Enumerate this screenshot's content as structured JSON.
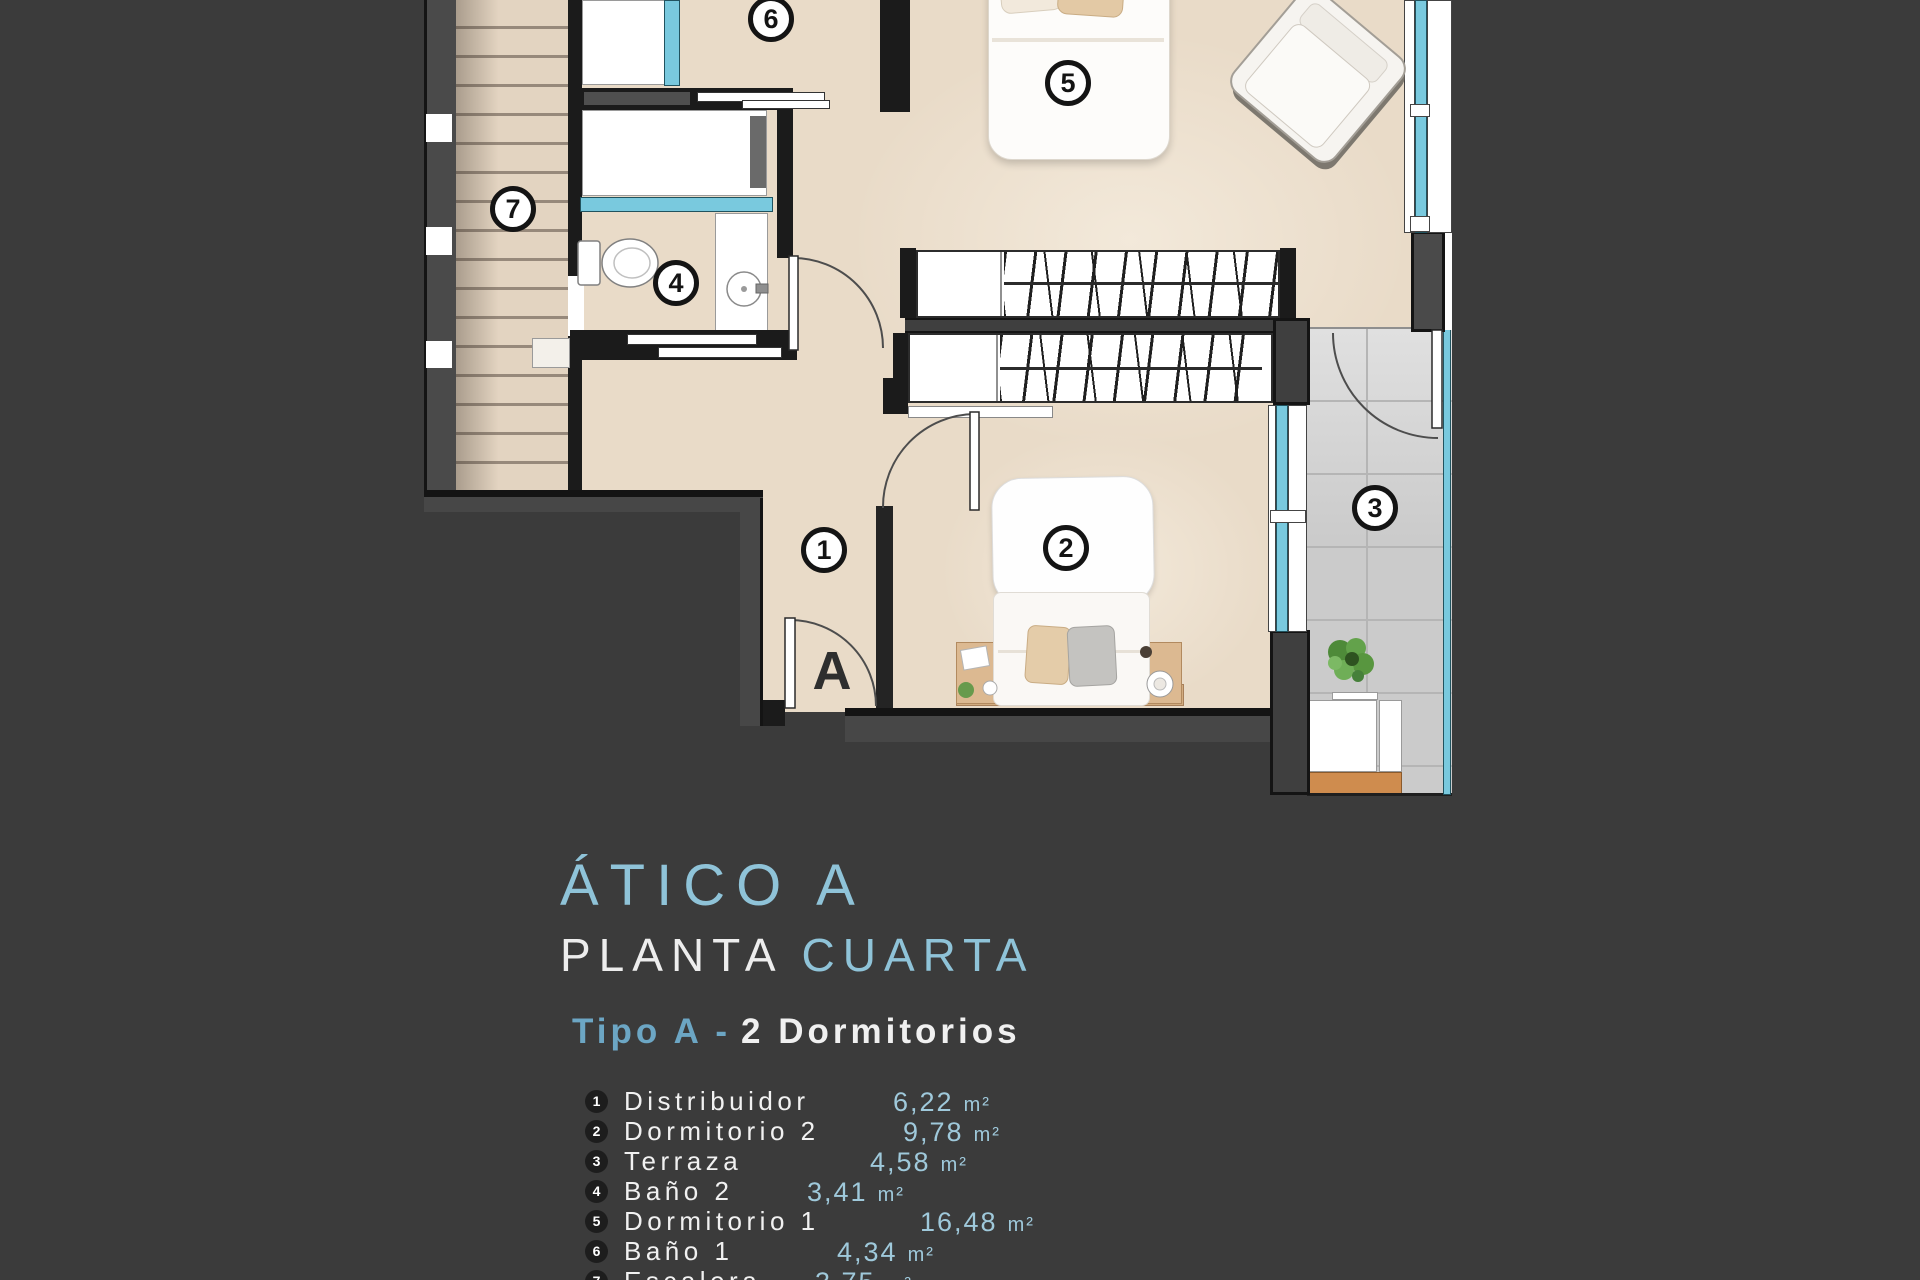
{
  "title": {
    "main": "ÁTICO A",
    "line2_white": "PLANTA",
    "line2_blue": "CUARTA",
    "type_blue": "Tipo A -",
    "type_white": "2 Dormitorios"
  },
  "plan": {
    "door_label": "A",
    "circles": [
      {
        "num": "1"
      },
      {
        "num": "2"
      },
      {
        "num": "3"
      },
      {
        "num": "4"
      },
      {
        "num": "5"
      },
      {
        "num": "6"
      },
      {
        "num": "7"
      }
    ]
  },
  "legend": {
    "items": [
      {
        "num": "1",
        "name": "Distribuidor",
        "value": "6,22",
        "unit": "m²"
      },
      {
        "num": "2",
        "name": "Dormitorio 2",
        "value": "9,78",
        "unit": "m²"
      },
      {
        "num": "3",
        "name": "Terraza",
        "value": "4,58",
        "unit": "m²"
      },
      {
        "num": "4",
        "name": "Baño 2",
        "value": "3,41",
        "unit": "m²"
      },
      {
        "num": "5",
        "name": "Dormitorio 1",
        "value": "16,48",
        "unit": "m²"
      },
      {
        "num": "6",
        "name": "Baño 1",
        "value": "4,34",
        "unit": "m²"
      },
      {
        "num": "7",
        "name": "Escalera",
        "value": "3,75",
        "unit": "m²"
      }
    ]
  },
  "colors": {
    "background": "#3b3b3b",
    "accent_blue": "#8fc3d8",
    "subtitle_blue": "#6ca6c4",
    "value_blue": "#9fc9db",
    "floor_beige": "#e9dbc8",
    "glass_cyan": "#79c9de",
    "terrace_gray": "#cecece",
    "wood_orange": "#cf8c4e"
  }
}
